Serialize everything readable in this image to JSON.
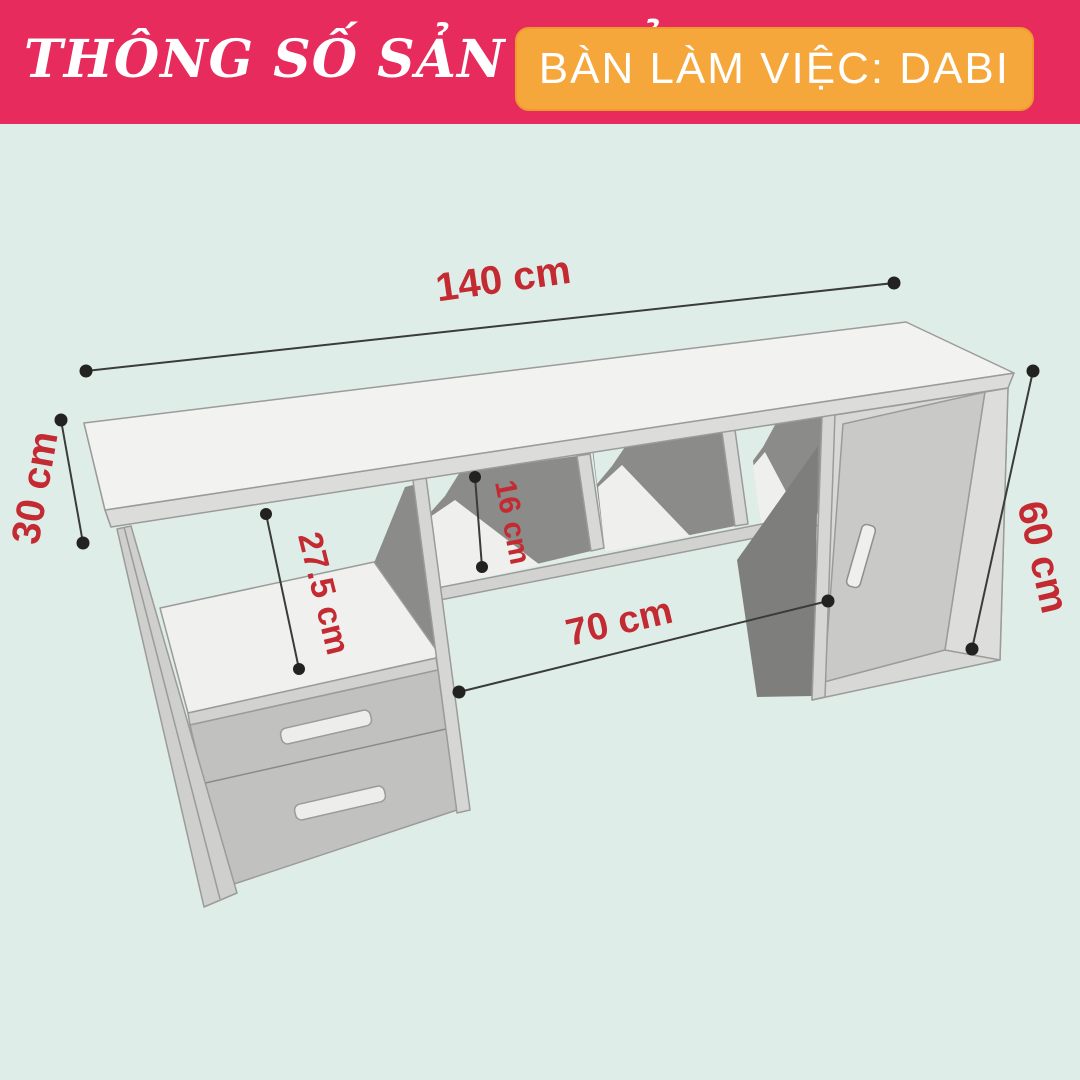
{
  "header": {
    "title": "THÔNG SỐ SẢN PHẨM",
    "product_badge": "BÀN LÀM VIỆC: DABI"
  },
  "diagram": {
    "subject": "desk-3d-spec-drawing",
    "dimensions": {
      "width": {
        "label": "140 cm"
      },
      "depth": {
        "label": "30 cm"
      },
      "height": {
        "label": "60 cm"
      },
      "shelf_clearance": {
        "label": "27.5 cm"
      },
      "cubby_height": {
        "label": "16 cm"
      },
      "knee_space": {
        "label": "70 cm"
      }
    }
  },
  "colors": {
    "header_pink": "#E72B5C",
    "badge_orange": "#F5A73C",
    "background_mint": "#DFEDE9",
    "dimension_red": "#C32A31",
    "wood_light": "#F2F2F0",
    "wood_shadow": "#8B8B89"
  }
}
